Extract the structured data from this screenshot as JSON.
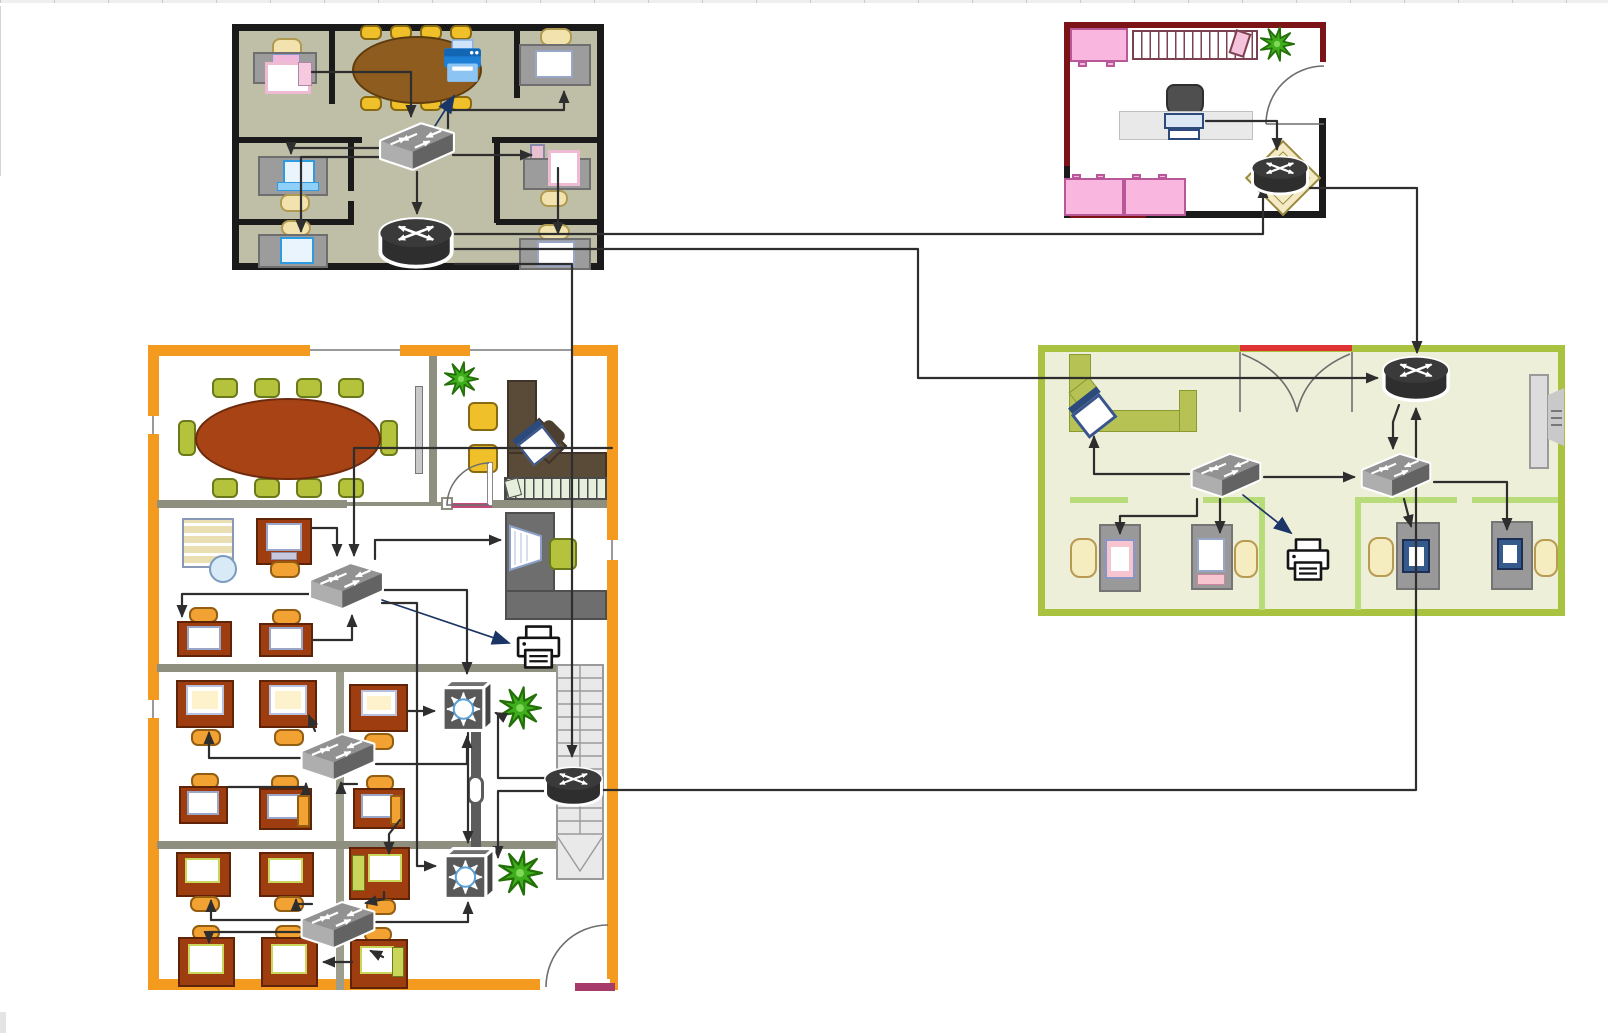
{
  "diagram": {
    "kind": "office-network-floorplan",
    "canvas": {
      "width": 1608,
      "height": 1033,
      "background": "#ffffff"
    }
  },
  "palette": {
    "connector": "#2e2e2e",
    "connector_navy": "#1b3566",
    "office_top_left_fill": "#bfbfa8",
    "office_top_left_wall": "#1a1a1a",
    "office_pink_border": "#7c1417",
    "office_pink_furniture": "#f9b6de",
    "office_green_border": "#a9c23f",
    "office_green_fill": "#edefd9",
    "office_orange_border": "#f49b1f",
    "office_orange_wall": "#8f8f80",
    "conference_table_brown": "#8d5c1e",
    "conference_table_rust": "#a84315",
    "device_dark": "#2e2e2e",
    "device_gray": "#8f8f8f",
    "plant_green": "#3fae1c"
  },
  "offices": [
    {
      "id": "office-top-left-olive",
      "x": 232,
      "y": 24,
      "w": 372,
      "h": 246
    },
    {
      "id": "office-top-right-pink",
      "x": 1064,
      "y": 22,
      "w": 262,
      "h": 196
    },
    {
      "id": "office-right-green",
      "x": 1038,
      "y": 345,
      "w": 527,
      "h": 271
    },
    {
      "id": "office-bottom-orange",
      "x": 148,
      "y": 345,
      "w": 470,
      "h": 645
    }
  ],
  "devices": [
    {
      "id": "switch-a",
      "type": "switch",
      "x": 379,
      "y": 120,
      "w": 76,
      "h": 52
    },
    {
      "id": "router-a",
      "type": "router",
      "x": 377,
      "y": 217,
      "w": 78,
      "h": 54
    },
    {
      "id": "router-b",
      "type": "router",
      "x": 1250,
      "y": 152,
      "w": 60,
      "h": 49
    },
    {
      "id": "router-c",
      "type": "router",
      "x": 1381,
      "y": 355,
      "w": 70,
      "h": 50
    },
    {
      "id": "switch-c1",
      "type": "switch",
      "x": 1188,
      "y": 451,
      "w": 76,
      "h": 48
    },
    {
      "id": "switch-c2",
      "type": "switch",
      "x": 1358,
      "y": 451,
      "w": 76,
      "h": 48
    },
    {
      "id": "switch-d1",
      "type": "switch",
      "x": 309,
      "y": 559,
      "w": 75,
      "h": 53
    },
    {
      "id": "switch-d2",
      "type": "switch",
      "x": 300,
      "y": 731,
      "w": 76,
      "h": 51
    },
    {
      "id": "switch-d3",
      "type": "switch",
      "x": 300,
      "y": 899,
      "w": 76,
      "h": 51
    },
    {
      "id": "hub-d1",
      "type": "hub",
      "x": 439,
      "y": 677,
      "w": 55,
      "h": 56
    },
    {
      "id": "hub-d2",
      "type": "hub",
      "x": 441,
      "y": 845,
      "w": 55,
      "h": 56
    },
    {
      "id": "router-d",
      "type": "router",
      "x": 543,
      "y": 760,
      "w": 61,
      "h": 55
    },
    {
      "id": "printer-a",
      "type": "printer_blue",
      "x": 441,
      "y": 39,
      "w": 43,
      "h": 47
    },
    {
      "id": "printer-c",
      "type": "printer_line",
      "x": 1284,
      "y": 537,
      "w": 48,
      "h": 47
    },
    {
      "id": "printer-d",
      "type": "printer_line",
      "x": 514,
      "y": 623,
      "w": 49,
      "h": 50
    }
  ],
  "connections": [
    {
      "from": "desk-a-topleft",
      "to": "switch-a",
      "color": "dark",
      "points": [
        [
          312,
          72
        ],
        [
          411,
          72
        ],
        [
          411,
          116
        ]
      ]
    },
    {
      "from": "switch-a",
      "to": "desk-a-topright",
      "color": "dark",
      "points": [
        [
          448,
          128
        ],
        [
          448,
          110
        ],
        [
          564,
          110
        ],
        [
          564,
          92
        ]
      ]
    },
    {
      "from": "switch-a",
      "to": "printer-a",
      "color": "navy",
      "points": [
        [
          428,
          137
        ],
        [
          454,
          96
        ]
      ]
    },
    {
      "from": "switch-a",
      "to": "desk-a-midleft",
      "color": "dark",
      "points": [
        [
          381,
          148
        ],
        [
          291,
          148
        ],
        [
          291,
          153
        ]
      ]
    },
    {
      "from": "switch-a",
      "to": "desk-a-botleft",
      "color": "dark",
      "points": [
        [
          381,
          157
        ],
        [
          301,
          157
        ],
        [
          301,
          231
        ]
      ]
    },
    {
      "from": "switch-a",
      "to": "desk-a-midright",
      "color": "dark",
      "points": [
        [
          453,
          155
        ],
        [
          531,
          155
        ]
      ]
    },
    {
      "from": "desk-a-midright",
      "to": "desk-a-botright",
      "color": "dark",
      "points": [
        [
          558,
          168
        ],
        [
          558,
          233
        ]
      ]
    },
    {
      "from": "switch-a",
      "to": "router-a",
      "color": "dark",
      "points": [
        [
          417,
          172
        ],
        [
          417,
          213
        ]
      ]
    },
    {
      "from": "router-a",
      "to": "router-b",
      "color": "dark",
      "points": [
        [
          455,
          234
        ],
        [
          1263,
          234
        ],
        [
          1263,
          187
        ]
      ]
    },
    {
      "from": "router-a",
      "to": "router-c",
      "color": "dark",
      "points": [
        [
          455,
          249
        ],
        [
          918,
          249
        ],
        [
          918,
          378
        ],
        [
          1377,
          378
        ]
      ]
    },
    {
      "from": "router-a",
      "to": "router-d",
      "color": "dark",
      "points": [
        [
          455,
          264
        ],
        [
          572,
          264
        ],
        [
          572,
          756
        ]
      ]
    },
    {
      "from": "laptop-b",
      "to": "router-b",
      "color": "dark",
      "points": [
        [
          1206,
          121
        ],
        [
          1277,
          121
        ],
        [
          1277,
          149
        ]
      ]
    },
    {
      "from": "router-b",
      "to": "router-c",
      "color": "dark",
      "points": [
        [
          1310,
          188
        ],
        [
          1417,
          188
        ],
        [
          1417,
          352
        ]
      ]
    },
    {
      "from": "router-c",
      "to": "switch-c2",
      "color": "dark",
      "points": [
        [
          1399,
          405
        ],
        [
          1393,
          422
        ],
        [
          1393,
          448
        ]
      ]
    },
    {
      "from": "router-d",
      "to": "router-c",
      "color": "dark",
      "points": [
        [
          584,
          790
        ],
        [
          1416,
          790
        ],
        [
          1416,
          409
        ]
      ]
    },
    {
      "from": "switch-c1",
      "to": "switch-c2",
      "color": "dark",
      "points": [
        [
          1264,
          477
        ],
        [
          1354,
          477
        ]
      ]
    },
    {
      "from": "switch-c1",
      "to": "angled-workstation",
      "color": "dark",
      "points": [
        [
          1189,
          474
        ],
        [
          1094,
          474
        ],
        [
          1094,
          437
        ]
      ]
    },
    {
      "from": "switch-c1",
      "to": "desk-c1",
      "color": "dark",
      "points": [
        [
          1197,
          499
        ],
        [
          1197,
          516
        ],
        [
          1120,
          516
        ],
        [
          1120,
          533
        ]
      ]
    },
    {
      "from": "switch-c1",
      "to": "desk-c2",
      "color": "dark",
      "points": [
        [
          1220,
          499
        ],
        [
          1220,
          532
        ]
      ]
    },
    {
      "from": "switch-c1",
      "to": "printer-c",
      "color": "navy",
      "points": [
        [
          1243,
          495
        ],
        [
          1291,
          533
        ]
      ]
    },
    {
      "from": "switch-c2",
      "to": "desk-c3",
      "color": "dark",
      "points": [
        [
          1404,
          499
        ],
        [
          1411,
          526
        ]
      ]
    },
    {
      "from": "switch-c2",
      "to": "desk-c4",
      "color": "dark",
      "points": [
        [
          1434,
          482
        ],
        [
          1507,
          482
        ],
        [
          1507,
          529
        ]
      ]
    },
    {
      "from": "desk-d-pc",
      "to": "switch-d1",
      "color": "dark",
      "points": [
        [
          312,
          528
        ],
        [
          337,
          528
        ],
        [
          337,
          555
        ]
      ]
    },
    {
      "from": "exec-laptop",
      "to": "switch-d1",
      "color": "dark",
      "points": [
        [
          612,
          448
        ],
        [
          354,
          448
        ],
        [
          354,
          555
        ]
      ]
    },
    {
      "from": "switch-d1",
      "to": "media-desk",
      "color": "dark",
      "points": [
        [
          375,
          559
        ],
        [
          375,
          540
        ],
        [
          500,
          540
        ]
      ]
    },
    {
      "from": "switch-d1",
      "to": "printer-d",
      "color": "navy",
      "points": [
        [
          382,
          600
        ],
        [
          509,
          643
        ]
      ]
    },
    {
      "from": "switch-d1",
      "to": "desk-d-b1",
      "color": "dark",
      "points": [
        [
          309,
          594
        ],
        [
          182,
          594
        ],
        [
          182,
          616
        ]
      ]
    },
    {
      "from": "desk-d-b2",
      "to": "switch-d1",
      "color": "dark",
      "points": [
        [
          313,
          640
        ],
        [
          352,
          640
        ],
        [
          352,
          616
        ]
      ]
    },
    {
      "from": "switch-d1",
      "to": "hub-d1",
      "color": "dark",
      "points": [
        [
          384,
          590
        ],
        [
          467,
          590
        ],
        [
          467,
          673
        ]
      ]
    },
    {
      "from": "switch-d1",
      "to": "hub-d2",
      "color": "dark",
      "points": [
        [
          382,
          603
        ],
        [
          417,
          603
        ],
        [
          417,
          866
        ],
        [
          435,
          866
        ]
      ]
    },
    {
      "from": "switch-d2",
      "to": "desk-e1",
      "color": "dark",
      "points": [
        [
          300,
          758
        ],
        [
          209,
          758
        ],
        [
          209,
          733
        ]
      ]
    },
    {
      "from": "switch-d2",
      "to": "desk-e2",
      "color": "dark",
      "points": [
        [
          315,
          731
        ],
        [
          309,
          716
        ]
      ]
    },
    {
      "from": "desk-e3",
      "to": "hub-d1",
      "color": "dark",
      "points": [
        [
          408,
          711
        ],
        [
          434,
          711
        ]
      ]
    },
    {
      "from": "switch-d2",
      "to": "hub-d1",
      "color": "dark",
      "points": [
        [
          376,
          764
        ],
        [
          467,
          764
        ],
        [
          467,
          737
        ]
      ]
    },
    {
      "from": "router-d",
      "to": "hub-d1",
      "color": "dark",
      "points": [
        [
          548,
          778
        ],
        [
          498,
          778
        ],
        [
          498,
          714
        ],
        [
          496,
          713
        ]
      ]
    },
    {
      "from": "hub-d1",
      "to": "hub-d2",
      "color": "dark",
      "points": [
        [
          468,
          733
        ],
        [
          468,
          842
        ]
      ]
    },
    {
      "from": "desk-f1",
      "to": "switch-d2",
      "color": "dark",
      "points": [
        [
          228,
          787
        ],
        [
          306,
          787
        ],
        [
          306,
          784
        ]
      ]
    },
    {
      "from": "desk-f3",
      "to": "switch-d2",
      "color": "dark",
      "points": [
        [
          357,
          784
        ],
        [
          341,
          784
        ],
        [
          341,
          783
        ]
      ]
    },
    {
      "from": "desk-f3",
      "to": "desk-g3",
      "color": "dark",
      "points": [
        [
          400,
          820
        ],
        [
          389,
          834
        ],
        [
          389,
          853
        ]
      ]
    },
    {
      "from": "switch-d3",
      "to": "desk-g1",
      "color": "dark",
      "points": [
        [
          300,
          920
        ],
        [
          211,
          920
        ],
        [
          211,
          901
        ]
      ]
    },
    {
      "from": "switch-d3",
      "to": "desk-g2",
      "color": "dark",
      "points": [
        [
          312,
          904
        ],
        [
          296,
          904
        ],
        [
          296,
          900
        ]
      ]
    },
    {
      "from": "desk-g3",
      "to": "switch-d3",
      "color": "dark",
      "points": [
        [
          384,
          892
        ],
        [
          384,
          899
        ],
        [
          366,
          903
        ]
      ]
    },
    {
      "from": "switch-d3",
      "to": "hub-d2",
      "color": "dark",
      "points": [
        [
          376,
          922
        ],
        [
          468,
          922
        ],
        [
          468,
          903
        ]
      ]
    },
    {
      "from": "switch-d3",
      "to": "desk-h1",
      "color": "dark",
      "points": [
        [
          300,
          932
        ],
        [
          209,
          932
        ],
        [
          209,
          942
        ]
      ]
    },
    {
      "from": "desk-h3",
      "to": "desk-h2",
      "color": "dark",
      "points": [
        [
          352,
          962
        ],
        [
          324,
          962
        ]
      ]
    },
    {
      "from": "desk-h3",
      "to": "switch-d3",
      "color": "dark",
      "points": [
        [
          383,
          957
        ],
        [
          371,
          951
        ]
      ]
    },
    {
      "from": "router-d",
      "to": "hub-d2",
      "color": "dark",
      "points": [
        [
          546,
          791
        ],
        [
          498,
          791
        ],
        [
          498,
          857
        ]
      ]
    }
  ]
}
